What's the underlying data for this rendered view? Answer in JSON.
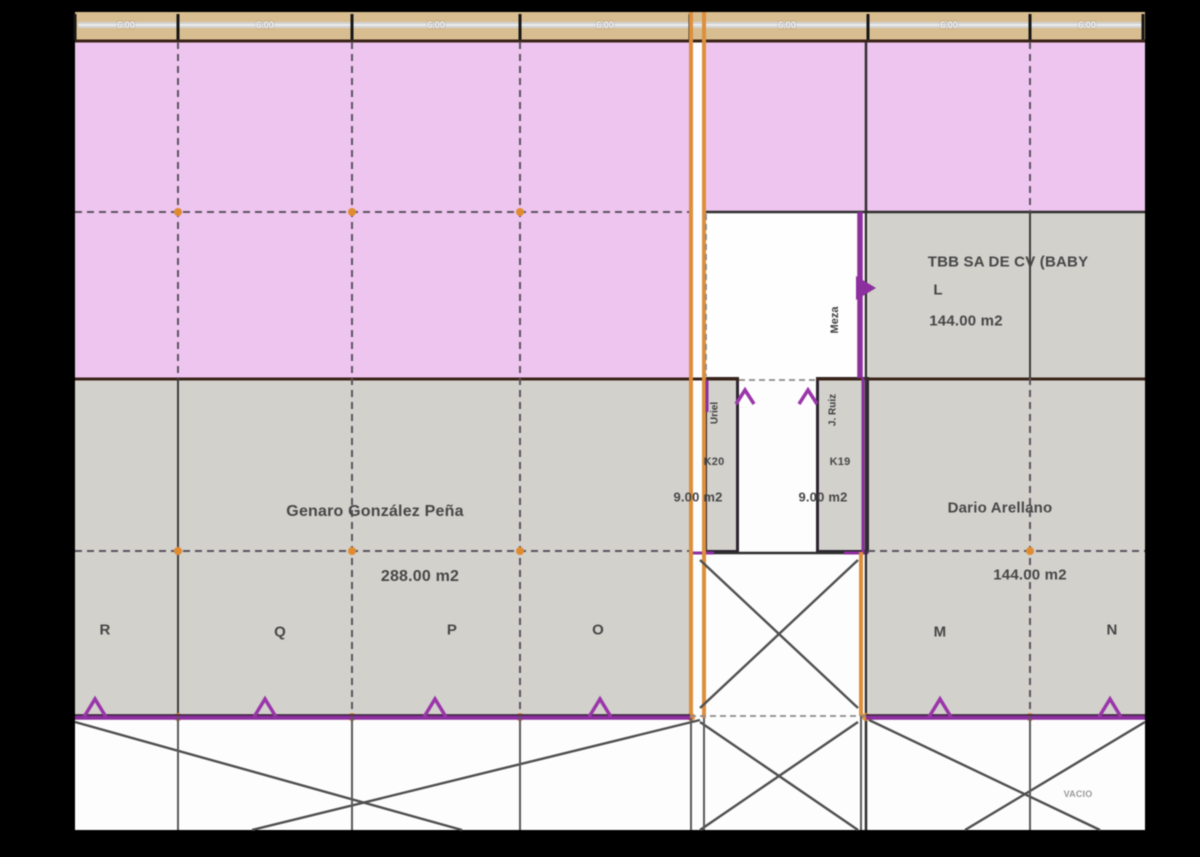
{
  "title": "Floor plan – market stalls",
  "colors": {
    "pink": "#eec5ef",
    "gray": "#d2d1cc",
    "tan": "#d8bd90",
    "orange": "#dd8f3c",
    "purple": "#8d2f9e",
    "brown": "#3a2418",
    "ink": "#474747"
  },
  "dimensions": [
    "6.00",
    "6.00",
    "6.00",
    "6.00",
    "6.00",
    "6.00",
    "6.00"
  ],
  "stalls": {
    "tbb": {
      "name": "TBB SA DE CV (BABY",
      "unit": "L",
      "area": "144.00 m2"
    },
    "genaro": {
      "name": "Genaro González Peña",
      "area": "288.00 m2"
    },
    "dario": {
      "name": "Dario Arellano",
      "area": "144.00 m2"
    },
    "k20": {
      "code": "K20",
      "area": "9.00 m2",
      "tenant": "Uriel"
    },
    "k19": {
      "code": "K19",
      "area": "9.00 m2",
      "tenant": "J. Ruiz",
      "tenant_surname": "Meza"
    }
  },
  "columns": {
    "letters": [
      "R",
      "Q",
      "P",
      "O",
      "M",
      "N"
    ]
  },
  "notes": {
    "vacio": "VACIO"
  }
}
